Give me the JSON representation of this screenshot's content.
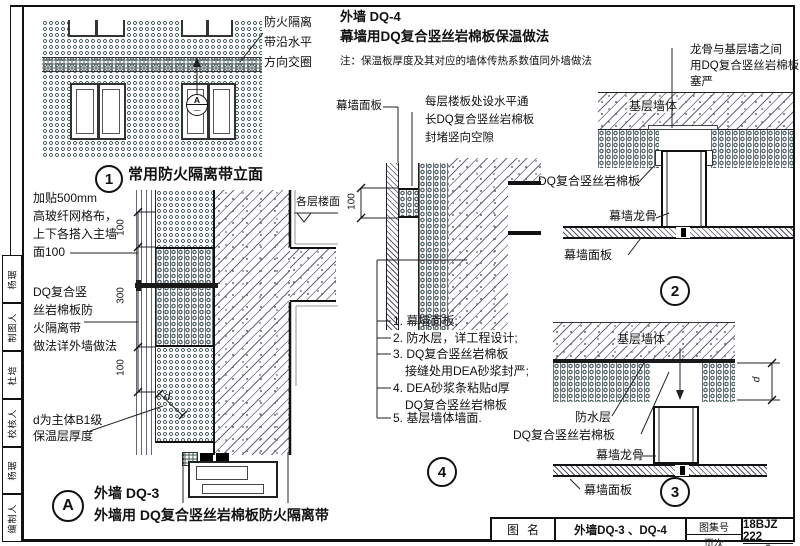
{
  "frame": {
    "signature": [
      {
        "role": "编制人",
        "name": "杨琚"
      },
      {
        "role": "校核人",
        "name": "杜培"
      },
      {
        "role": "制图人",
        "name": "杨琚"
      }
    ]
  },
  "heading": {
    "code": "外墙 DQ-4",
    "title": "幕墙用DQ复合竖丝岩棉板保温做法",
    "note": "注：保温板厚度及其对应的墙体传热系数值同外墙做法"
  },
  "elevation": {
    "num": "1",
    "caption": "常用防火隔离带立面",
    "annotation": [
      "防火隔离",
      "带沿水平",
      "方向交圈"
    ],
    "marker_top": "A",
    "marker_bottom": "—"
  },
  "detail_a": {
    "callout": "A",
    "code": "外墙 DQ-3",
    "caption": "外墙用 DQ复合竖丝岩棉板防火隔离带",
    "floor_label": "各层楼面",
    "dim_top": "100",
    "dim_mid": "300",
    "dim_bot": "100",
    "dim_d": "d",
    "note_mesh": [
      "加贴500mm",
      "高玻纤网格布，",
      "上下各搭入主墙",
      "面100"
    ],
    "note_band": [
      "DQ复合竖",
      "丝岩棉板防",
      "火隔离带",
      "做法详外墙做法"
    ],
    "note_d": [
      "d为主体B1级",
      "保温层厚度"
    ]
  },
  "detail_4": {
    "num": "4",
    "label_panel": "幕墙面板",
    "label_blocking": [
      "每层楼板处设水平通",
      "长DQ复合竖丝岩棉板",
      "封堵竖向空隙"
    ],
    "dim": "100",
    "list": [
      "1. 幕墙面板;",
      "2. 防水层，详工程设计;",
      "3. DQ复合竖丝岩棉板",
      "接缝处用DEA砂浆封严;",
      "4. DEA砂浆条粘贴d厚",
      "DQ复合竖丝岩棉板",
      "5. 基层墙体墙面."
    ]
  },
  "detail_2": {
    "num": "2",
    "note": [
      "龙骨与基层墙之间",
      "用DQ复合竖丝岩棉板",
      "塞严"
    ],
    "label_wall": "基层墙体",
    "label_ins": "DQ复合竖丝岩棉板",
    "label_mullion": "幕墙龙骨",
    "label_panel": "幕墙面板"
  },
  "detail_3": {
    "num": "3",
    "label_wall": "基层墙体",
    "label_waterproof": "防水层",
    "label_ins": "DQ复合竖丝岩棉板",
    "label_mullion": "幕墙龙骨",
    "label_panel": "幕墙面板",
    "dim_d": "d"
  },
  "titleblock": {
    "name_label": "图名",
    "name": "外墙DQ-3 、DQ-4",
    "atlas_label": "图集号",
    "atlas": "18BJZ 222",
    "page_label": "页次",
    "page": "6"
  },
  "colors": {
    "line": "#1a1a1a",
    "hatch": "#556066",
    "paper": "#ffffff"
  }
}
